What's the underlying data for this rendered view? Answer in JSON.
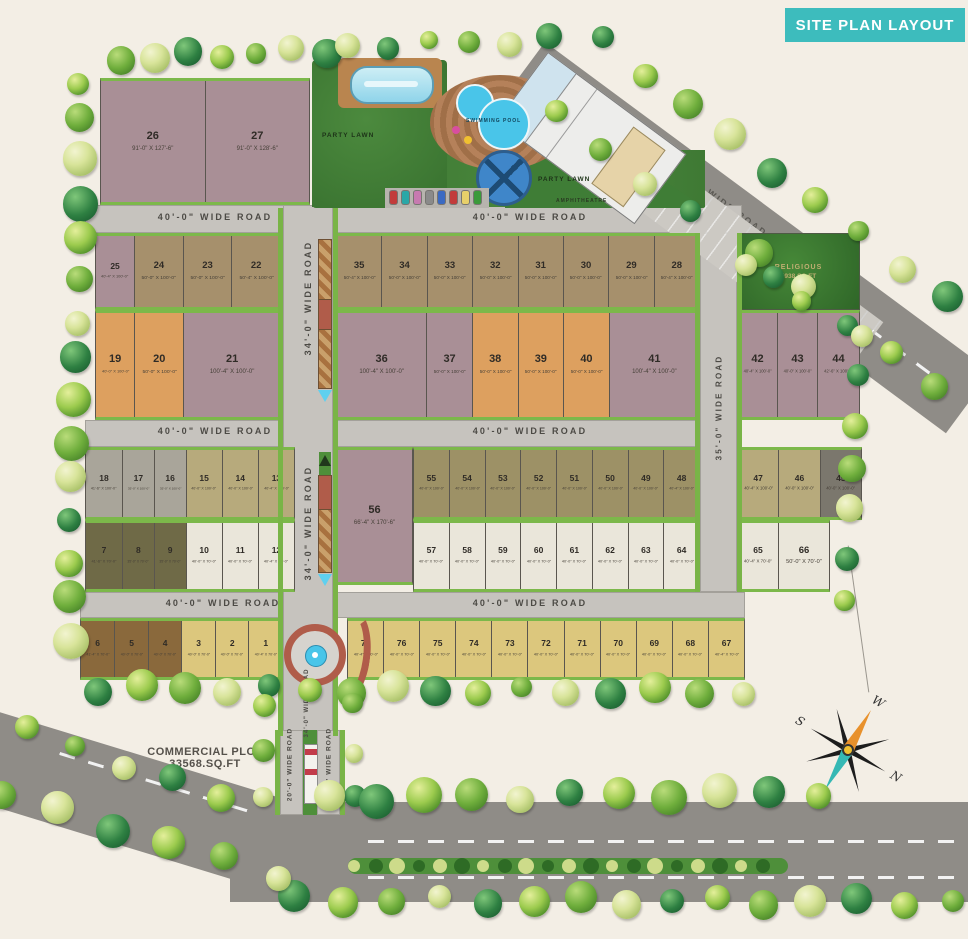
{
  "title": "SITE PLAN LAYOUT",
  "colors": {
    "banner": "#3dbcbd",
    "road": "#c6c3be",
    "road_dark": "#8f8c87",
    "green_strip": "#79b447",
    "lawn": "#3f7d36",
    "water": "#49c5e9",
    "median_red": "#b05c4a"
  },
  "palette": {
    "mauve": "#a98f96",
    "tan": "#a6906c",
    "orange": "#dda05f",
    "gray": "#a9a59a",
    "khaki": "#b7aa7c",
    "olive": "#9d9166",
    "darkolive": "#6f6a47",
    "cream": "#eae6da",
    "darkgray": "#7b776d",
    "brown": "#8a693c",
    "yellow": "#dcc77d"
  },
  "roads": {
    "w40": "40'-0\" WIDE ROAD",
    "w34": "34'-0\" WIDE ROAD",
    "w35": "35'-0\" WIDE ROAD",
    "w80": "80'-0\" WIDE ROAD",
    "w20": "20'-0\" WIDE ROAD"
  },
  "amenities": {
    "party_lawn": "PARTY LAWN",
    "party_lawn_2": "PARTY LAWN",
    "swimming_pool": "SWIMMING POOL",
    "amphitheatre": "AMPHITHEATRE"
  },
  "religious": {
    "line1": "RELIGIOUS",
    "line2": "5938 SQ.FT"
  },
  "commercial": {
    "line1": "COMMERCIAL PLOT",
    "line2": "33568.SQ.FT"
  },
  "compass": {
    "n": "N",
    "s": "S",
    "e": "E",
    "w": "W"
  },
  "plots": {
    "blocks": [
      {
        "id": "b2627",
        "items": [
          {
            "no": "26",
            "dim": "91'-0\" X 127'-6\"",
            "cat": "mauve"
          },
          {
            "no": "27",
            "dim": "91'-0\" X 128'-6\"",
            "cat": "mauve"
          }
        ]
      },
      {
        "id": "b25_22",
        "items": [
          {
            "no": "25",
            "dim": "40'-4\" X 100'-0\"",
            "cat": "mauve"
          },
          {
            "no": "24",
            "dim": "50'-0\" X 100'-0\"",
            "cat": "tan"
          },
          {
            "no": "23",
            "dim": "50'-0\" X 100'-0\"",
            "cat": "tan"
          },
          {
            "no": "22",
            "dim": "50'-4\" X 100'-0\"",
            "cat": "tan"
          }
        ]
      },
      {
        "id": "b35_28",
        "items": [
          {
            "no": "35",
            "dim": "50'-4\" X 100'-0\"",
            "cat": "tan"
          },
          {
            "no": "34",
            "dim": "50'-0\" X 100'-0\"",
            "cat": "tan"
          },
          {
            "no": "33",
            "dim": "50'-0\" X 100'-0\"",
            "cat": "tan"
          },
          {
            "no": "32",
            "dim": "50'-0\" X 100'-0\"",
            "cat": "tan"
          },
          {
            "no": "31",
            "dim": "50'-0\" X 100'-0\"",
            "cat": "tan"
          },
          {
            "no": "30",
            "dim": "50'-0\" X 100'-0\"",
            "cat": "tan"
          },
          {
            "no": "29",
            "dim": "50'-0\" X 100'-0\"",
            "cat": "tan"
          },
          {
            "no": "28",
            "dim": "50'-4\" X 100'-0\"",
            "cat": "tan"
          }
        ]
      },
      {
        "id": "b19_21",
        "items": [
          {
            "no": "19",
            "dim": "40'-0\" X 100'-0\"",
            "cat": "orange"
          },
          {
            "no": "20",
            "dim": "50'-0\" X 100'-0\"",
            "cat": "orange"
          },
          {
            "no": "21",
            "dim": "100'-4\" X 100'-0\"",
            "cat": "mauve"
          }
        ]
      },
      {
        "id": "b36_41",
        "items": [
          {
            "no": "36",
            "dim": "100'-4\" X 100'-0\"",
            "cat": "mauve"
          },
          {
            "no": "37",
            "dim": "50'-0\" X 100'-0\"",
            "cat": "mauve"
          },
          {
            "no": "38",
            "dim": "50'-0\" X 100'-0\"",
            "cat": "orange"
          },
          {
            "no": "39",
            "dim": "50'-0\" X 100'-0\"",
            "cat": "orange"
          },
          {
            "no": "40",
            "dim": "50'-0\" X 100'-0\"",
            "cat": "orange"
          },
          {
            "no": "41",
            "dim": "100'-4\" X 100'-0\"",
            "cat": "mauve"
          }
        ]
      },
      {
        "id": "b42_44",
        "items": [
          {
            "no": "42",
            "dim": "40'-4\" X 100'-0\"",
            "cat": "mauve"
          },
          {
            "no": "43",
            "dim": "40'-0\" X 100'-0\"",
            "cat": "mauve"
          },
          {
            "no": "44",
            "dim": "42'-6\" X 100'-0\"",
            "cat": "mauve"
          }
        ]
      },
      {
        "id": "b18_13",
        "items": [
          {
            "no": "18",
            "dim": "41'-6\" X 100'-0\"",
            "cat": "gray"
          },
          {
            "no": "17",
            "dim": "35'-0\" X 100'-0\"",
            "cat": "gray"
          },
          {
            "no": "16",
            "dim": "35'-0\" X 100'-0\"",
            "cat": "gray"
          },
          {
            "no": "15",
            "dim": "40'-0\" X 100'-0\"",
            "cat": "khaki"
          },
          {
            "no": "14",
            "dim": "40'-0\" X 100'-0\"",
            "cat": "khaki"
          },
          {
            "no": "13",
            "dim": "40'-4\" X 100'-0\"",
            "cat": "khaki"
          }
        ]
      },
      {
        "id": "b7_12",
        "items": [
          {
            "no": "7",
            "dim": "41'-6\" X 70'-0\"",
            "cat": "darkolive"
          },
          {
            "no": "8",
            "dim": "35'-0\" X 70'-0\"",
            "cat": "darkolive"
          },
          {
            "no": "9",
            "dim": "35'-0\" X 70'-0\"",
            "cat": "darkolive"
          },
          {
            "no": "10",
            "dim": "40'-0\" X 70'-0\"",
            "cat": "cream"
          },
          {
            "no": "11",
            "dim": "40'-0\" X 70'-0\"",
            "cat": "cream"
          },
          {
            "no": "12",
            "dim": "40'-4\" X 70'-0\"",
            "cat": "cream"
          }
        ]
      },
      {
        "id": "b56",
        "items": [
          {
            "no": "56",
            "dim": "66'-4\" X 170'-6\"",
            "cat": "mauve"
          }
        ]
      },
      {
        "id": "b55_48",
        "items": [
          {
            "no": "55",
            "dim": "40'-0\" X 100'-0\"",
            "cat": "olive"
          },
          {
            "no": "54",
            "dim": "40'-0\" X 100'-0\"",
            "cat": "olive"
          },
          {
            "no": "53",
            "dim": "40'-0\" X 100'-0\"",
            "cat": "olive"
          },
          {
            "no": "52",
            "dim": "40'-0\" X 100'-0\"",
            "cat": "olive"
          },
          {
            "no": "51",
            "dim": "40'-0\" X 100'-0\"",
            "cat": "olive"
          },
          {
            "no": "50",
            "dim": "40'-0\" X 100'-0\"",
            "cat": "olive"
          },
          {
            "no": "49",
            "dim": "40'-0\" X 100'-0\"",
            "cat": "olive"
          },
          {
            "no": "48",
            "dim": "40'-4\" X 100'-0\"",
            "cat": "olive"
          }
        ]
      },
      {
        "id": "b57_64",
        "items": [
          {
            "no": "57",
            "dim": "40'-0\" X 70'-0\"",
            "cat": "cream"
          },
          {
            "no": "58",
            "dim": "40'-0\" X 70'-0\"",
            "cat": "cream"
          },
          {
            "no": "59",
            "dim": "40'-0\" X 70'-0\"",
            "cat": "cream"
          },
          {
            "no": "60",
            "dim": "40'-0\" X 70'-0\"",
            "cat": "cream"
          },
          {
            "no": "61",
            "dim": "40'-0\" X 70'-0\"",
            "cat": "cream"
          },
          {
            "no": "62",
            "dim": "40'-0\" X 70'-0\"",
            "cat": "cream"
          },
          {
            "no": "63",
            "dim": "40'-0\" X 70'-0\"",
            "cat": "cream"
          },
          {
            "no": "64",
            "dim": "40'-0\" X 70'-0\"",
            "cat": "cream"
          }
        ]
      },
      {
        "id": "b47_45",
        "items": [
          {
            "no": "47",
            "dim": "40'-4\" X 100'-0\"",
            "cat": "khaki"
          },
          {
            "no": "46",
            "dim": "40'-0\" X 100'-0\"",
            "cat": "khaki"
          },
          {
            "no": "45",
            "dim": "40'-0\" X 100'-0\"",
            "cat": "darkgray"
          }
        ]
      },
      {
        "id": "b65_66",
        "items": [
          {
            "no": "65",
            "dim": "40'-4\" X 70'-0\"",
            "cat": "cream"
          },
          {
            "no": "66",
            "dim": "50'-0\" X 70'-0\"",
            "cat": "cream"
          }
        ]
      },
      {
        "id": "b6_1",
        "items": [
          {
            "no": "6",
            "dim": "41'-4\" X 70'-0\"",
            "cat": "brown"
          },
          {
            "no": "5",
            "dim": "40'-0\" X 70'-0\"",
            "cat": "brown"
          },
          {
            "no": "4",
            "dim": "40'-0\" X 70'-0\"",
            "cat": "brown"
          },
          {
            "no": "3",
            "dim": "40'-0\" X 70'-0\"",
            "cat": "yellow"
          },
          {
            "no": "2",
            "dim": "40'-0\" X 70'-0\"",
            "cat": "yellow"
          },
          {
            "no": "1",
            "dim": "40'-4\" X 70'-0\"",
            "cat": "yellow"
          }
        ]
      },
      {
        "id": "b77_67",
        "items": [
          {
            "no": "77",
            "dim": "40'-4\" X 70'-0\"",
            "cat": "yellow"
          },
          {
            "no": "76",
            "dim": "40'-0\" X 70'-0\"",
            "cat": "yellow"
          },
          {
            "no": "75",
            "dim": "40'-0\" X 70'-0\"",
            "cat": "yellow"
          },
          {
            "no": "74",
            "dim": "40'-0\" X 70'-0\"",
            "cat": "yellow"
          },
          {
            "no": "73",
            "dim": "40'-0\" X 70'-0\"",
            "cat": "yellow"
          },
          {
            "no": "72",
            "dim": "40'-0\" X 70'-0\"",
            "cat": "yellow"
          },
          {
            "no": "71",
            "dim": "40'-0\" X 70'-0\"",
            "cat": "yellow"
          },
          {
            "no": "70",
            "dim": "40'-0\" X 70'-0\"",
            "cat": "yellow"
          },
          {
            "no": "69",
            "dim": "40'-0\" X 70'-0\"",
            "cat": "yellow"
          },
          {
            "no": "68",
            "dim": "40'-0\" X 70'-0\"",
            "cat": "yellow"
          },
          {
            "no": "67",
            "dim": "40'-4\" X 70'-0\"",
            "cat": "yellow"
          }
        ]
      }
    ]
  }
}
